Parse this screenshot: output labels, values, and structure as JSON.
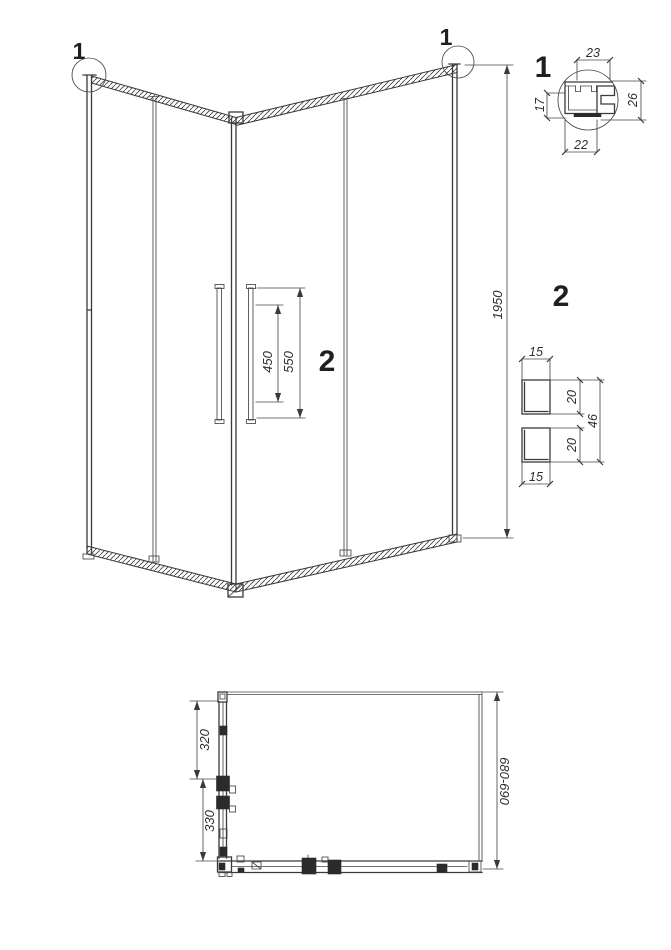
{
  "drawing_title": "Corner shower enclosure technical drawing",
  "colors": {
    "line": "#3a3a3a",
    "text": "#2e2e2e",
    "background": "#ffffff"
  },
  "elevation": {
    "callout_left": "1",
    "callout_right": "1",
    "door_panel_label": "2",
    "height": "1950",
    "handle_mount_spacing": "450",
    "handle_length": "550"
  },
  "detail_1": {
    "label": "1",
    "top": "23",
    "left": "17",
    "right": "26",
    "bottom": "22"
  },
  "detail_2": {
    "label": "2",
    "top_width": "15",
    "upper_height": "20",
    "lower_height": "20",
    "overall_height": "46",
    "bottom_width": "15"
  },
  "plan": {
    "upper_offset": "320",
    "lower_offset": "330",
    "depth_range": "680-690"
  }
}
